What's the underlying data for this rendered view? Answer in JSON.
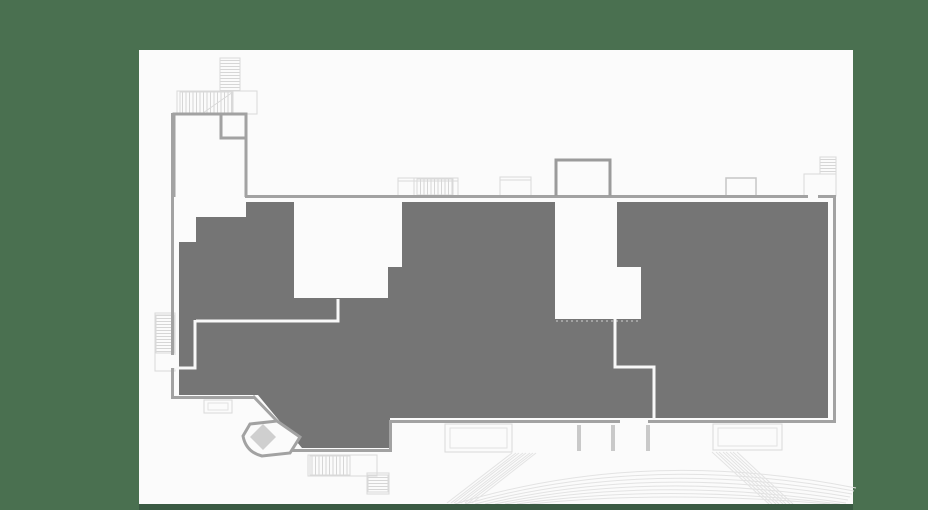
{
  "colors": {
    "background": "#4A7050",
    "canvas": "#FBFBFB",
    "zone_fill": "#757575",
    "wall": "#A2A2A2",
    "wall_dark": "#9B9B9B",
    "detail": "#D9D9D9",
    "detail_mid": "#C6C6C6",
    "inner_outline": "#E2E2E2",
    "hatch": "#D6D6D6",
    "arc": "#E3E3E3",
    "stub": "#C9C9C9",
    "diamond_fill": "#CFCFCF",
    "diamond_stroke": "#C2C2C2",
    "dashed_edge": "#CFCFCF",
    "corridor": "#F8F8F8",
    "bottom_bar": "#3A5A43"
  },
  "plan": {
    "kind": "venue-floor-plan",
    "highlighted_zone": {
      "selected": true
    },
    "features": [
      "upper-ladder",
      "upper-stair-block",
      "tall-room",
      "inner-corner-room",
      "entrance-stair",
      "lobby-room-left",
      "center-protruding-room",
      "lobby-room-right",
      "top-right-room",
      "top-right-stair",
      "left-stairwell",
      "left-annex-box",
      "kiosk-pentagon",
      "kiosk-diamond",
      "stage-box",
      "right-annex-box",
      "pit-stubs",
      "lower-stair-horizontal",
      "lower-stair-vertical",
      "seating-arcs",
      "aisle-band-left",
      "aisle-band-right"
    ]
  }
}
